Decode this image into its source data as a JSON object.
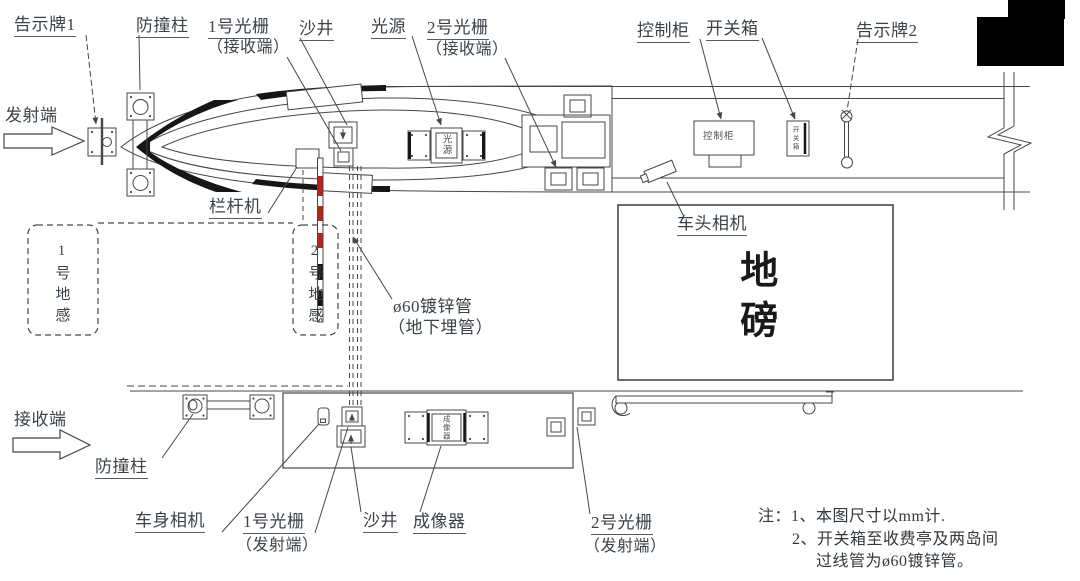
{
  "labels": {
    "notice1": "告示牌1",
    "crash_top": "防撞柱",
    "g1rx": "1号光栅",
    "g1rx_sub": "（接收端）",
    "manhole_top": "沙井",
    "light": "光源",
    "g2rx": "2号光栅",
    "g2rx_sub": "（接收端）",
    "cabinet": "控制柜",
    "switchbox": "开关箱",
    "notice2": "告示牌2",
    "tx_end": "发射端",
    "rx_end": "接收端",
    "barrier": "栏杆机",
    "loop1": "1号地感",
    "loop2": "2号地感",
    "pipe": "ø60镀锌管",
    "pipe_sub": "（地下埋管）",
    "head_cam": "车头相机",
    "weighbridge": "地磅",
    "crash_bottom": "防撞柱",
    "body_cam": "车身相机",
    "g1tx": "1号光栅",
    "g1tx_sub": "（发射端）",
    "manhole_bottom": "沙井",
    "imager": "成像器",
    "g2tx": "2号光栅",
    "g2tx_sub": "（发射端）"
  },
  "device_texts": {
    "light_box": "光源",
    "cabinet_box": "控制柜",
    "switch_box": "开关箱",
    "imager_box": "成像器"
  },
  "notes": {
    "line1": "注：1、本图尺寸以mm计.",
    "line2": "2、开关箱至收费亭及两岛间",
    "line3": "过线管为ø60镀锌管。"
  },
  "colors": {
    "line": "#474747",
    "text": "#3c4249",
    "arm_red": "#b5231d",
    "arm_black": "#161616",
    "redact": "#000000"
  }
}
